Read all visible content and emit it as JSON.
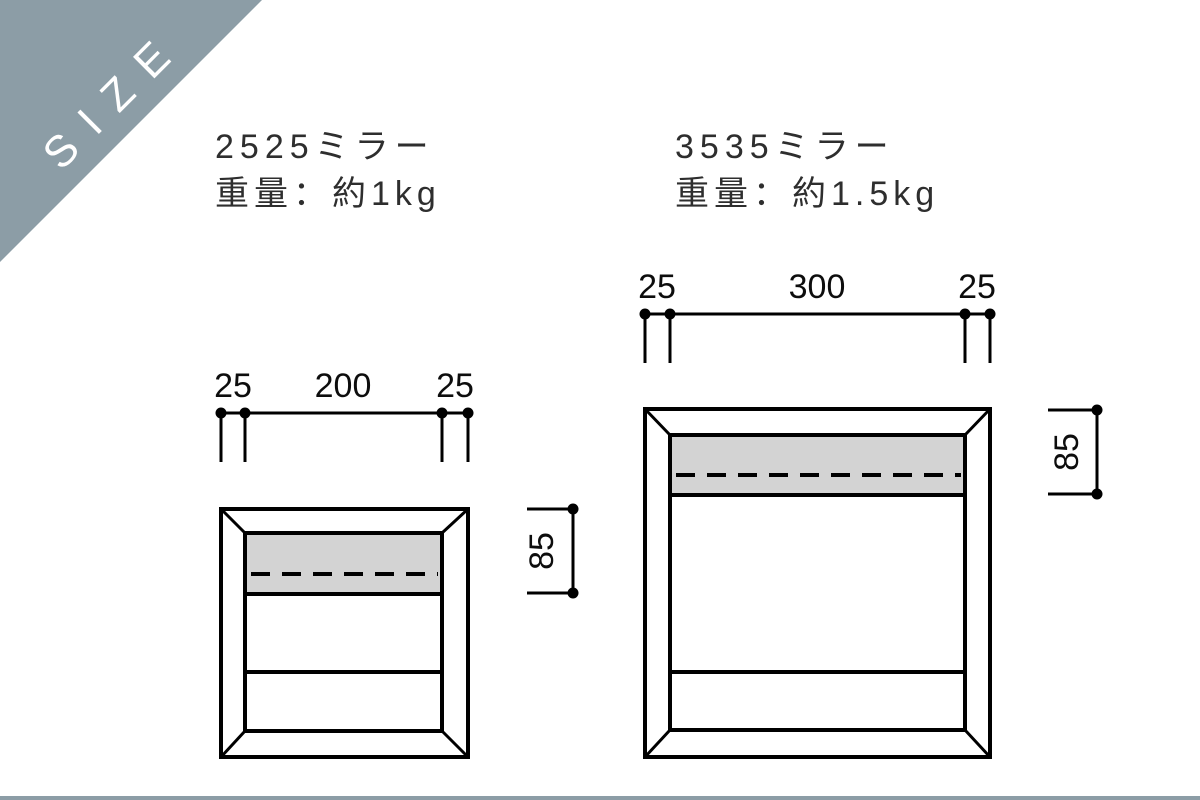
{
  "badge": {
    "label": "SIZE",
    "color": "#8C9DA6"
  },
  "products": [
    {
      "name": "2525ミラー",
      "weight_label": "重量：約1kg",
      "dimensions": {
        "left_frame": "25",
        "inner_width": "200",
        "right_frame": "25",
        "band_height": "85"
      }
    },
    {
      "name": "3535ミラー",
      "weight_label": "重量：約1.5kg",
      "dimensions": {
        "left_frame": "25",
        "inner_width": "300",
        "right_frame": "25",
        "band_height": "85"
      }
    }
  ],
  "colors": {
    "accent": "#8C9DA6",
    "band_fill": "#D3D3D3",
    "line": "#000000",
    "footer_bar": "#8C9DA6"
  }
}
